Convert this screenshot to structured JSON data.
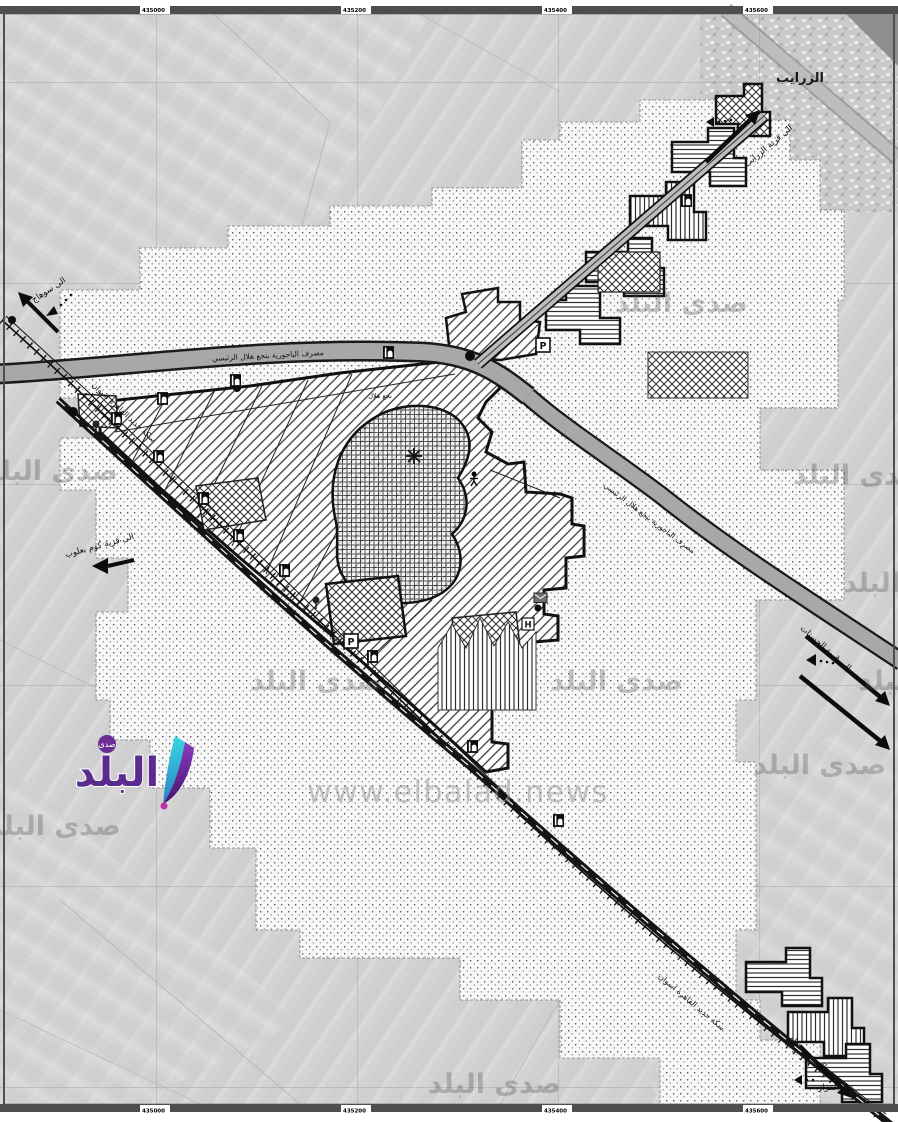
{
  "page": {
    "type": "scanned urban-boundary zoning map over aerial photo with news watermark"
  },
  "watermark": {
    "brand": "صدى البلد",
    "url": "www.elbalad.news",
    "logo": {
      "main": "البلد",
      "sub": "صدى"
    }
  },
  "labels": {
    "village_zarayib": "الزرايب",
    "to_zarayib": "الى قرية الزرايب",
    "to_sohag": "الى سوهاج",
    "railway_north": "سكة حديد القاهرة اسوان",
    "railway_south": "سكة حديد القاهرة اسوان",
    "drain_main": "مصرف الباجورية بنجع هلال الرئيسي",
    "drain_branch": "مصرف الباجورية بنجع هلال الرئيسي",
    "to_kom_baaloub": "الى قرية كوم بعلوب",
    "to_hasanat": "الى قرية الحسنات",
    "core_village": "نجع هلال",
    "nag_qazzaz": "نجع القزاز",
    "to_nag_hammam": "الى نجع همام",
    "marker_parking": "P",
    "marker_parking2": "P",
    "marker_hospital": "H"
  },
  "grid": {
    "top_labels": [
      "435000",
      "435200",
      "435400",
      "435600"
    ],
    "bottom_labels": [
      "435000",
      "435200",
      "435400",
      "435600"
    ]
  }
}
